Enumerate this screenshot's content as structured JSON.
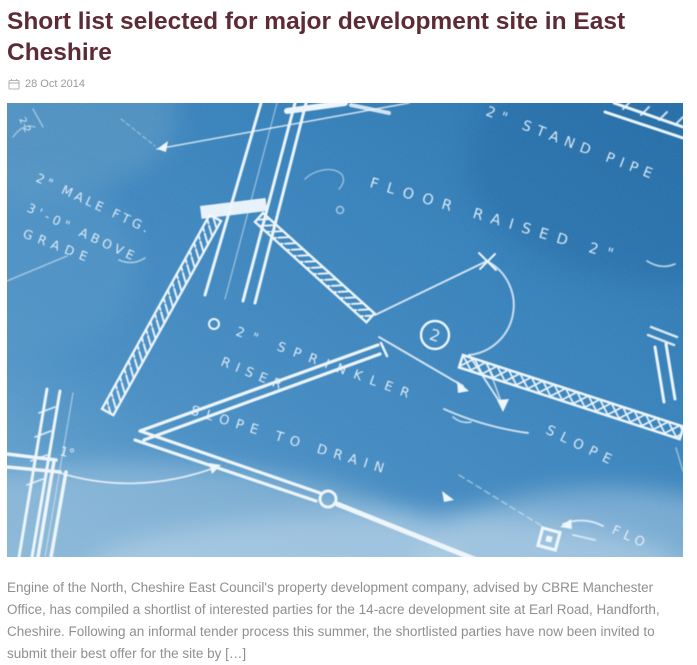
{
  "page": {
    "heading": "Short list selected for major development site in East Cheshire",
    "date": "28 Oct 2014",
    "excerpt": "Engine of the North, Cheshire East Council's property development company, advised by CBRE Manchester Office, has compiled a shortlist of interested parties for the 14-acre development site at Earl Road, Handforth, Cheshire. Following an informal tender process this summer, the shortlisted parties have now been invited to submit their best offer for the site by […]"
  },
  "blueprint": {
    "labels": {
      "dim": "2-2",
      "stand_pipe": "2\" STAND PIPE",
      "floor_raised": "FLOOR RAISED 2\"",
      "male_ftg_line1": "2\" MALE FTG.",
      "male_ftg_line2": "3'-0\" ABOVE",
      "male_ftg_line3": "GRADE",
      "sprinkler_line1": "2\" SPRINKLER",
      "sprinkler_line2": "RISER",
      "detail_number": "2",
      "slope_to_drain": "SLOPE TO DRAIN",
      "slope": "SLOPE",
      "grade_note": "1°",
      "flo": "FLO"
    },
    "colors": {
      "paper_blue": "#2e7cb8",
      "line_white": "#eef6fc"
    }
  },
  "theme": {
    "heading_color": "#5d2b35",
    "meta_color": "#9a9a9a",
    "body_color": "#8f8f8f"
  }
}
